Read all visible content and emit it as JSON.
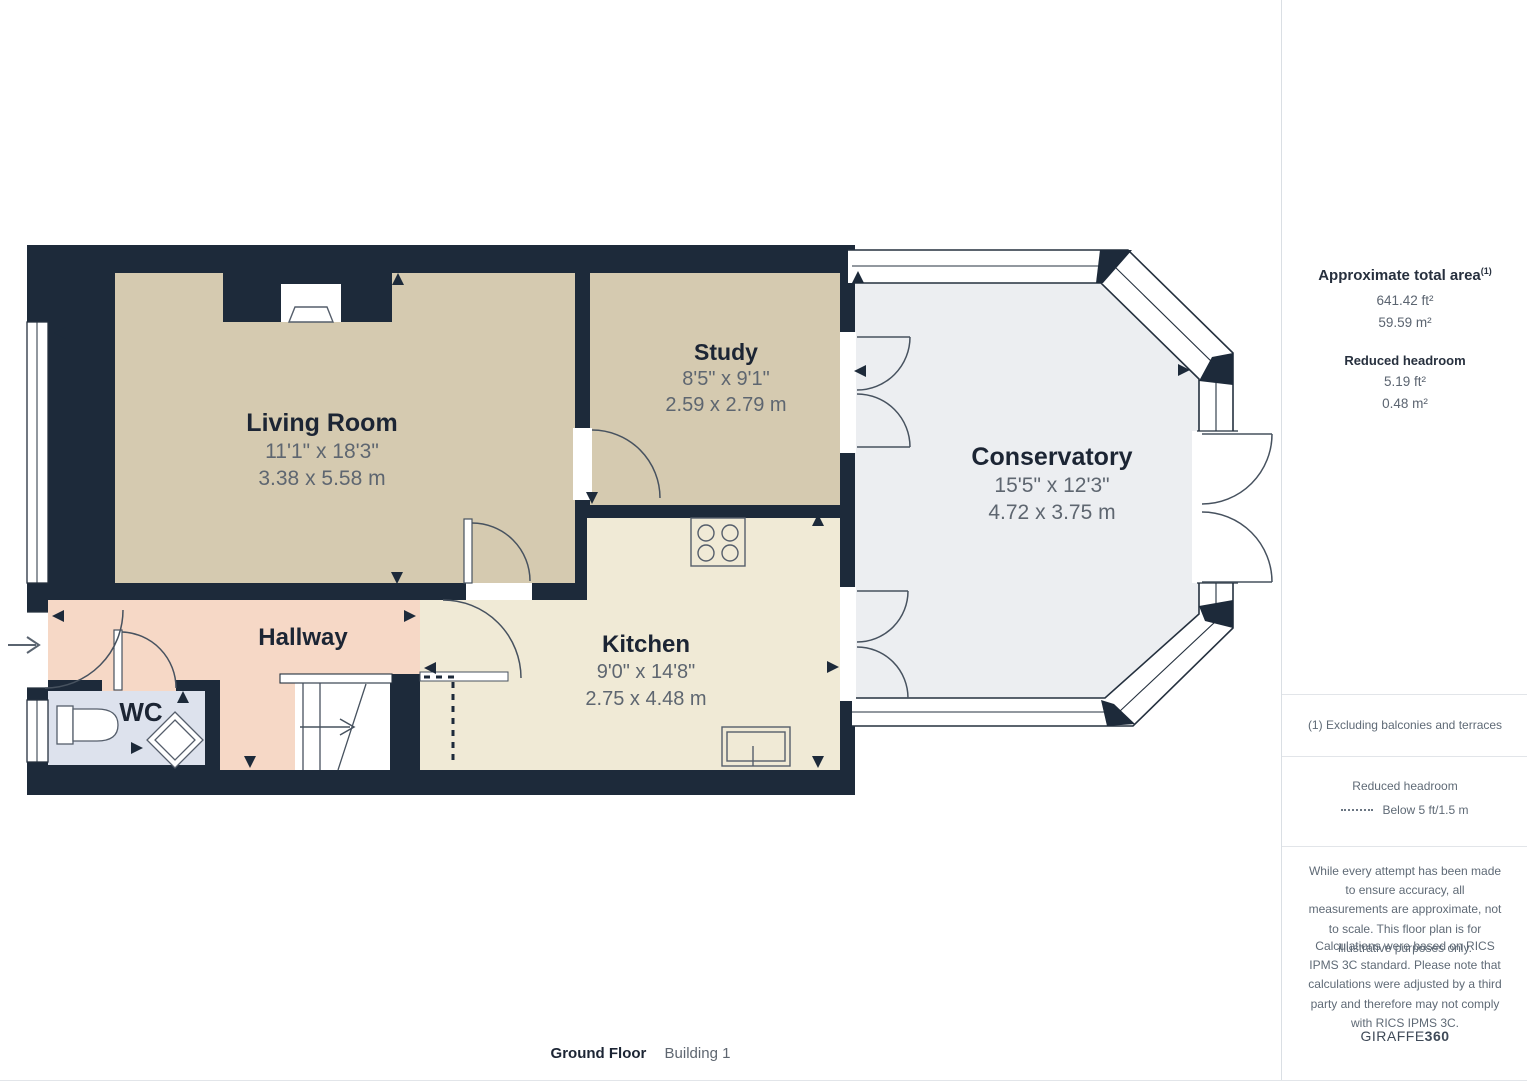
{
  "plan": {
    "rooms": [
      {
        "name": "Living Room",
        "dim_ft": "11'1\" x 18'3\"",
        "dim_m": "3.38 x 5.58 m"
      },
      {
        "name": "Study",
        "dim_ft": "8'5\" x 9'1\"",
        "dim_m": "2.59 x 2.79 m"
      },
      {
        "name": "Conservatory",
        "dim_ft": "15'5\" x 12'3\"",
        "dim_m": "4.72 x 3.75 m"
      },
      {
        "name": "Kitchen",
        "dim_ft": "9'0\" x 14'8\"",
        "dim_m": "2.75 x 4.48 m"
      },
      {
        "name": "Hallway"
      },
      {
        "name": "WC"
      }
    ]
  },
  "sidebar": {
    "total_area": {
      "title": "Approximate total area",
      "sup": "(1)",
      "ft": "641.42 ft²",
      "m": "59.59 m²"
    },
    "reduced_headroom": {
      "title": "Reduced headroom",
      "ft": "5.19 ft²",
      "m": "0.48 m²"
    },
    "footnote": "(1) Excluding balconies and terraces",
    "legend": {
      "title": "Reduced headroom",
      "label": "Below 5 ft/1.5 m"
    },
    "disclaimer1": "While every attempt has been made to ensure accuracy, all measurements are approximate, not to scale. This floor plan is for illustrative purposes only.",
    "disclaimer2": "Calculations were based on RICS IPMS 3C standard. Please note that calculations were adjusted by a third party and therefore may not comply with RICS IPMS 3C.",
    "brand": {
      "name": "GIRAFFE",
      "bold": "360"
    }
  },
  "footer": {
    "floor": "Ground Floor",
    "building": "Building 1"
  },
  "colors": {
    "wall": "#1d2a3a",
    "living": "#d5cab0",
    "kitchen": "#f0ead6",
    "hallway": "#f6d8c6",
    "wc": "#dde2ed",
    "conservatory": "#eceef1"
  }
}
